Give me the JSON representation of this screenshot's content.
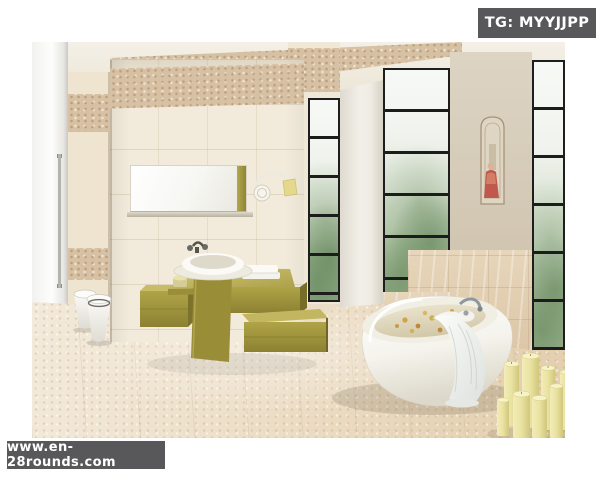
{
  "page": {
    "width": 600,
    "height": 480,
    "background": "#ffffff"
  },
  "overlays": {
    "tag_badge": {
      "text": "TG: MYYJJPP",
      "background": "#58585a",
      "text_color": "#ffffff"
    },
    "watermark_badge": {
      "text": "www.en-28rounds.com",
      "background": "#58585a",
      "text_color": "#ffffff"
    }
  },
  "photo": {
    "alt": "Modern bathroom interior: beige stone-tile walls with tan mosaic bands, wall mirror with olive accent, olive-green floating vanity with round white vessel sink and towels, white wall-hung toilet and bidet behind a glass door, tall black-framed frosted windows with greenery, decorative figure art panel on beige wall, freestanding white oval bathtub with petals, chrome faucet and draped white towel, pale yellow pillar candles on beige tiled floor",
    "palette": {
      "ceiling": "#f2eee4",
      "wall_tile_cream": "#f1e9d8",
      "wall_band_tan": "#d6c1a5",
      "accent_olive": "#a89c42",
      "floor_beige": "#ecd9bf",
      "window_frame_black": "#1e1e1e",
      "foliage_green": "#8fa983",
      "marble_beige": "#e2cfb2",
      "fixture_white": "#f8f7f3",
      "candle_yellow": "#e9e3a2",
      "art_red": "#c0584e"
    }
  }
}
